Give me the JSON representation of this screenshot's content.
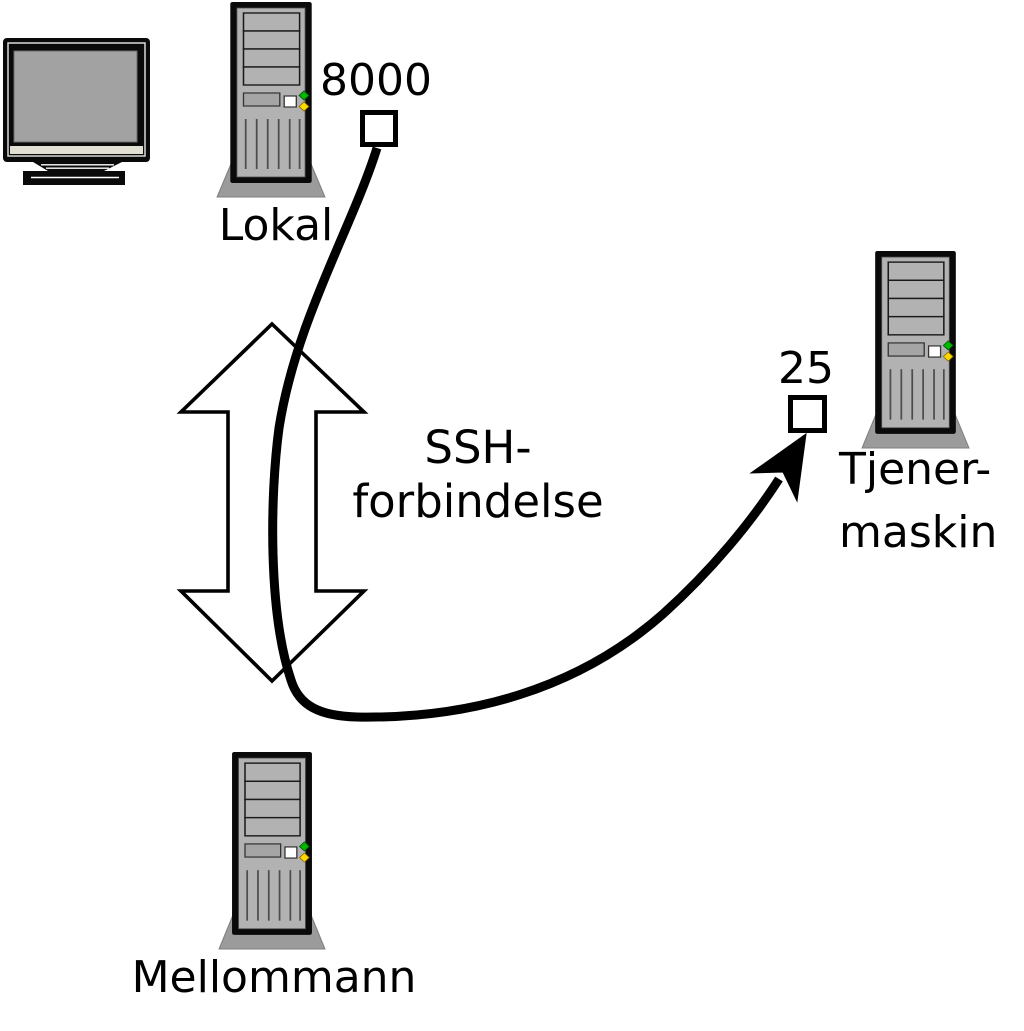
{
  "diagram": {
    "local": {
      "label": "Lokal",
      "port": "8000"
    },
    "middleman": {
      "label": "Mellommann"
    },
    "server": {
      "label_line1": "Tjener-",
      "label_line2": "maskin",
      "port": "25"
    },
    "ssh": {
      "line1": "SSH-",
      "line2": "forbindelse"
    }
  },
  "icons": {
    "monitor": "crt-monitor-icon",
    "local_computer": "tower-computer-icon",
    "middleman_computer": "tower-computer-icon",
    "server_computer": "tower-computer-icon",
    "tunnel": "double-arrow-up-down-icon",
    "connection": "curved-cable-arrow-icon",
    "local_port_box": "port-square",
    "server_port_box": "port-square"
  },
  "colors": {
    "line": "#000000",
    "background": "#ffffff",
    "tower_body": "#b2b2b2",
    "tower_base": "#9b9b9b",
    "led_green": "#00b800",
    "led_yellow": "#ffd800",
    "monitor_screen": "#a2a2a2",
    "monitor_strip": "#e1e0d3"
  }
}
